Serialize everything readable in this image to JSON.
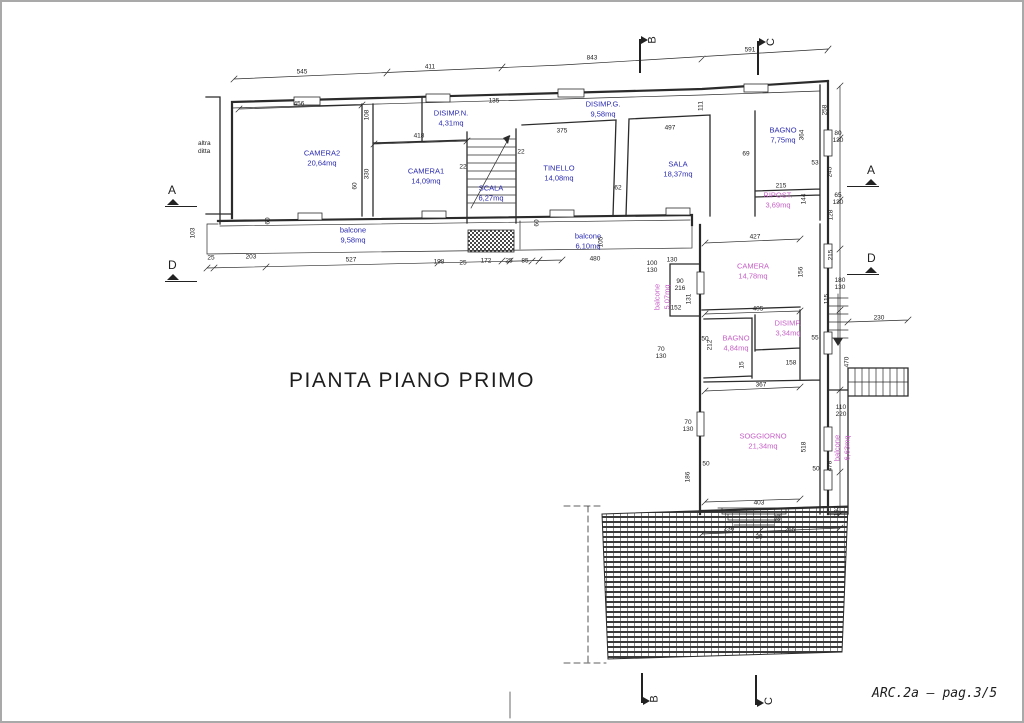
{
  "page": {
    "title": "PIANTA PIANO PRIMO",
    "sheet_ref": "ARC.2a  –  pag.3/5",
    "side_note": "altra\nditta"
  },
  "colors": {
    "blue_label": "#2a2ab2",
    "pink_label": "#c75fc7",
    "line": "#2b2b2b"
  },
  "rooms": [
    {
      "label": "CAMERA2",
      "area": "20,64mq",
      "cls": "blue",
      "x": 320,
      "y": 156
    },
    {
      "label": "CAMERA1",
      "area": "14,09mq",
      "cls": "blue",
      "x": 424,
      "y": 174
    },
    {
      "label": "DISIMP.N.",
      "area": "4,31mq",
      "cls": "blue",
      "x": 449,
      "y": 116
    },
    {
      "label": "DISIMP.G.",
      "area": "9,58mq",
      "cls": "blue",
      "x": 601,
      "y": 107
    },
    {
      "label": "TINELLO",
      "area": "14,08mq",
      "cls": "blue",
      "x": 557,
      "y": 171
    },
    {
      "label": "SALA",
      "area": "18,37mq",
      "cls": "blue",
      "x": 676,
      "y": 167
    },
    {
      "label": "SCALA",
      "area": "6,27mq",
      "cls": "blue",
      "x": 489,
      "y": 191
    },
    {
      "label": "BAGNO",
      "area": "7,75mq",
      "cls": "blue",
      "x": 781,
      "y": 133
    },
    {
      "label": "RIPOST.",
      "area": "3,69mq",
      "cls": "pink",
      "x": 776,
      "y": 198
    },
    {
      "label": "CAMERA",
      "area": "14,78mq",
      "cls": "pink",
      "x": 751,
      "y": 269
    },
    {
      "label": "DISIMP.",
      "area": "3,34mq",
      "cls": "pink",
      "x": 786,
      "y": 326
    },
    {
      "label": "BAGNO",
      "area": "4,84mq",
      "cls": "pink",
      "x": 734,
      "y": 341
    },
    {
      "label": "SOGGIORNO",
      "area": "21,34mq",
      "cls": "pink",
      "x": 761,
      "y": 439
    },
    {
      "label": "balcone",
      "area": "9,58mq",
      "cls": "blue",
      "x": 351,
      "y": 233
    },
    {
      "label": "balcone",
      "area": "6,10mq",
      "cls": "blue",
      "x": 586,
      "y": 239
    },
    {
      "label": "balcone",
      "area": "5,07mq",
      "cls": "pink rot",
      "x": 660,
      "y": 295
    },
    {
      "label": "balcone",
      "area": "6,63mq",
      "cls": "pink rot",
      "x": 840,
      "y": 446
    }
  ],
  "markers": [
    {
      "label": "A",
      "cls": "m-side",
      "x": 163,
      "y": 181
    },
    {
      "label": "D",
      "cls": "m-side",
      "x": 163,
      "y": 256
    },
    {
      "label": "B",
      "cls": "m-top",
      "x": 630,
      "y": 28
    },
    {
      "label": "C",
      "cls": "m-top",
      "x": 748,
      "y": 30
    },
    {
      "label": "A",
      "cls": "m-side m-flip",
      "x": 845,
      "y": 161
    },
    {
      "label": "D",
      "cls": "m-side m-flip",
      "x": 845,
      "y": 249
    },
    {
      "label": "B",
      "cls": "m-bottom",
      "x": 632,
      "y": 668
    },
    {
      "label": "C",
      "cls": "m-bottom",
      "x": 746,
      "y": 670
    }
  ],
  "dims": [
    {
      "t": "545",
      "x": 300,
      "y": 71
    },
    {
      "t": "411",
      "x": 428,
      "y": 66
    },
    {
      "t": "843",
      "x": 590,
      "y": 57
    },
    {
      "t": "591",
      "x": 748,
      "y": 49
    },
    {
      "t": "456",
      "x": 297,
      "y": 103
    },
    {
      "t": "135",
      "x": 492,
      "y": 100
    },
    {
      "t": "418",
      "x": 417,
      "y": 135
    },
    {
      "t": "375",
      "x": 560,
      "y": 130
    },
    {
      "t": "497",
      "x": 668,
      "y": 127
    },
    {
      "t": "111",
      "x": 700,
      "y": 104,
      "cls": "rot"
    },
    {
      "t": "108",
      "x": 366,
      "y": 113,
      "cls": "rot"
    },
    {
      "t": "330",
      "x": 366,
      "y": 172,
      "cls": "rot"
    },
    {
      "t": "60",
      "x": 354,
      "y": 184,
      "cls": "rot"
    },
    {
      "t": "22",
      "x": 461,
      "y": 166
    },
    {
      "t": "22",
      "x": 519,
      "y": 151
    },
    {
      "t": "62",
      "x": 616,
      "y": 187
    },
    {
      "t": "69",
      "x": 744,
      "y": 153
    },
    {
      "t": "53",
      "x": 813,
      "y": 162
    },
    {
      "t": "215",
      "x": 779,
      "y": 185
    },
    {
      "t": "103",
      "x": 192,
      "y": 231,
      "cls": "rot"
    },
    {
      "t": "25",
      "x": 209,
      "y": 257
    },
    {
      "t": "203",
      "x": 249,
      "y": 256
    },
    {
      "t": "527",
      "x": 349,
      "y": 259
    },
    {
      "t": "198",
      "x": 437,
      "y": 261
    },
    {
      "t": "25",
      "x": 461,
      "y": 262
    },
    {
      "t": "172",
      "x": 484,
      "y": 260
    },
    {
      "t": "25",
      "x": 507,
      "y": 260
    },
    {
      "t": "85",
      "x": 523,
      "y": 260
    },
    {
      "t": "480",
      "x": 593,
      "y": 258
    },
    {
      "t": "130",
      "x": 670,
      "y": 259
    },
    {
      "t": "60",
      "x": 267,
      "y": 219,
      "cls": "rot"
    },
    {
      "t": "60",
      "x": 536,
      "y": 221,
      "cls": "rot"
    },
    {
      "t": "105",
      "x": 600,
      "y": 240,
      "cls": "rot"
    },
    {
      "t": "427",
      "x": 753,
      "y": 236
    },
    {
      "t": "405",
      "x": 756,
      "y": 308
    },
    {
      "t": "367",
      "x": 759,
      "y": 384
    },
    {
      "t": "403",
      "x": 757,
      "y": 502
    },
    {
      "t": "158",
      "x": 789,
      "y": 362
    },
    {
      "t": "50",
      "x": 703,
      "y": 338
    },
    {
      "t": "55",
      "x": 813,
      "y": 337
    },
    {
      "t": "212",
      "x": 709,
      "y": 343,
      "cls": "rot"
    },
    {
      "t": "15",
      "x": 741,
      "y": 363,
      "cls": "rot"
    },
    {
      "t": "156",
      "x": 800,
      "y": 270,
      "cls": "rot"
    },
    {
      "t": "131",
      "x": 688,
      "y": 297,
      "cls": "rot"
    },
    {
      "t": "152",
      "x": 674,
      "y": 307
    },
    {
      "t": "90\n216",
      "x": 678,
      "y": 284
    },
    {
      "t": "100\n130",
      "x": 650,
      "y": 266
    },
    {
      "t": "70\n130",
      "x": 659,
      "y": 352
    },
    {
      "t": "70\n130",
      "x": 686,
      "y": 425
    },
    {
      "t": "110\n220",
      "x": 839,
      "y": 410
    },
    {
      "t": "50",
      "x": 704,
      "y": 463
    },
    {
      "t": "50",
      "x": 814,
      "y": 468
    },
    {
      "t": "186",
      "x": 687,
      "y": 475,
      "cls": "rot"
    },
    {
      "t": "518",
      "x": 803,
      "y": 445,
      "cls": "rot"
    },
    {
      "t": "478",
      "x": 829,
      "y": 464,
      "cls": "rot"
    },
    {
      "t": "193",
      "x": 836,
      "y": 509,
      "cls": "rot"
    },
    {
      "t": "35",
      "x": 777,
      "y": 516,
      "cls": "rot"
    },
    {
      "t": "28",
      "x": 757,
      "y": 536
    },
    {
      "t": "236",
      "x": 727,
      "y": 528
    },
    {
      "t": "265",
      "x": 788,
      "y": 529
    },
    {
      "t": "230",
      "x": 877,
      "y": 317
    },
    {
      "t": "470",
      "x": 846,
      "y": 360,
      "cls": "rot"
    },
    {
      "t": "180\n130",
      "x": 838,
      "y": 283
    },
    {
      "t": "115",
      "x": 826,
      "y": 297,
      "cls": "rot"
    },
    {
      "t": "215",
      "x": 830,
      "y": 253,
      "cls": "rot"
    },
    {
      "t": "128",
      "x": 830,
      "y": 213,
      "cls": "rot"
    },
    {
      "t": "65\n130",
      "x": 836,
      "y": 198
    },
    {
      "t": "144",
      "x": 803,
      "y": 197,
      "cls": "rot"
    },
    {
      "t": "80\n130",
      "x": 836,
      "y": 136
    },
    {
      "t": "258",
      "x": 824,
      "y": 108,
      "cls": "rot"
    },
    {
      "t": "364",
      "x": 801,
      "y": 133,
      "cls": "rot"
    },
    {
      "t": "245",
      "x": 829,
      "y": 170,
      "cls": "rot"
    }
  ]
}
